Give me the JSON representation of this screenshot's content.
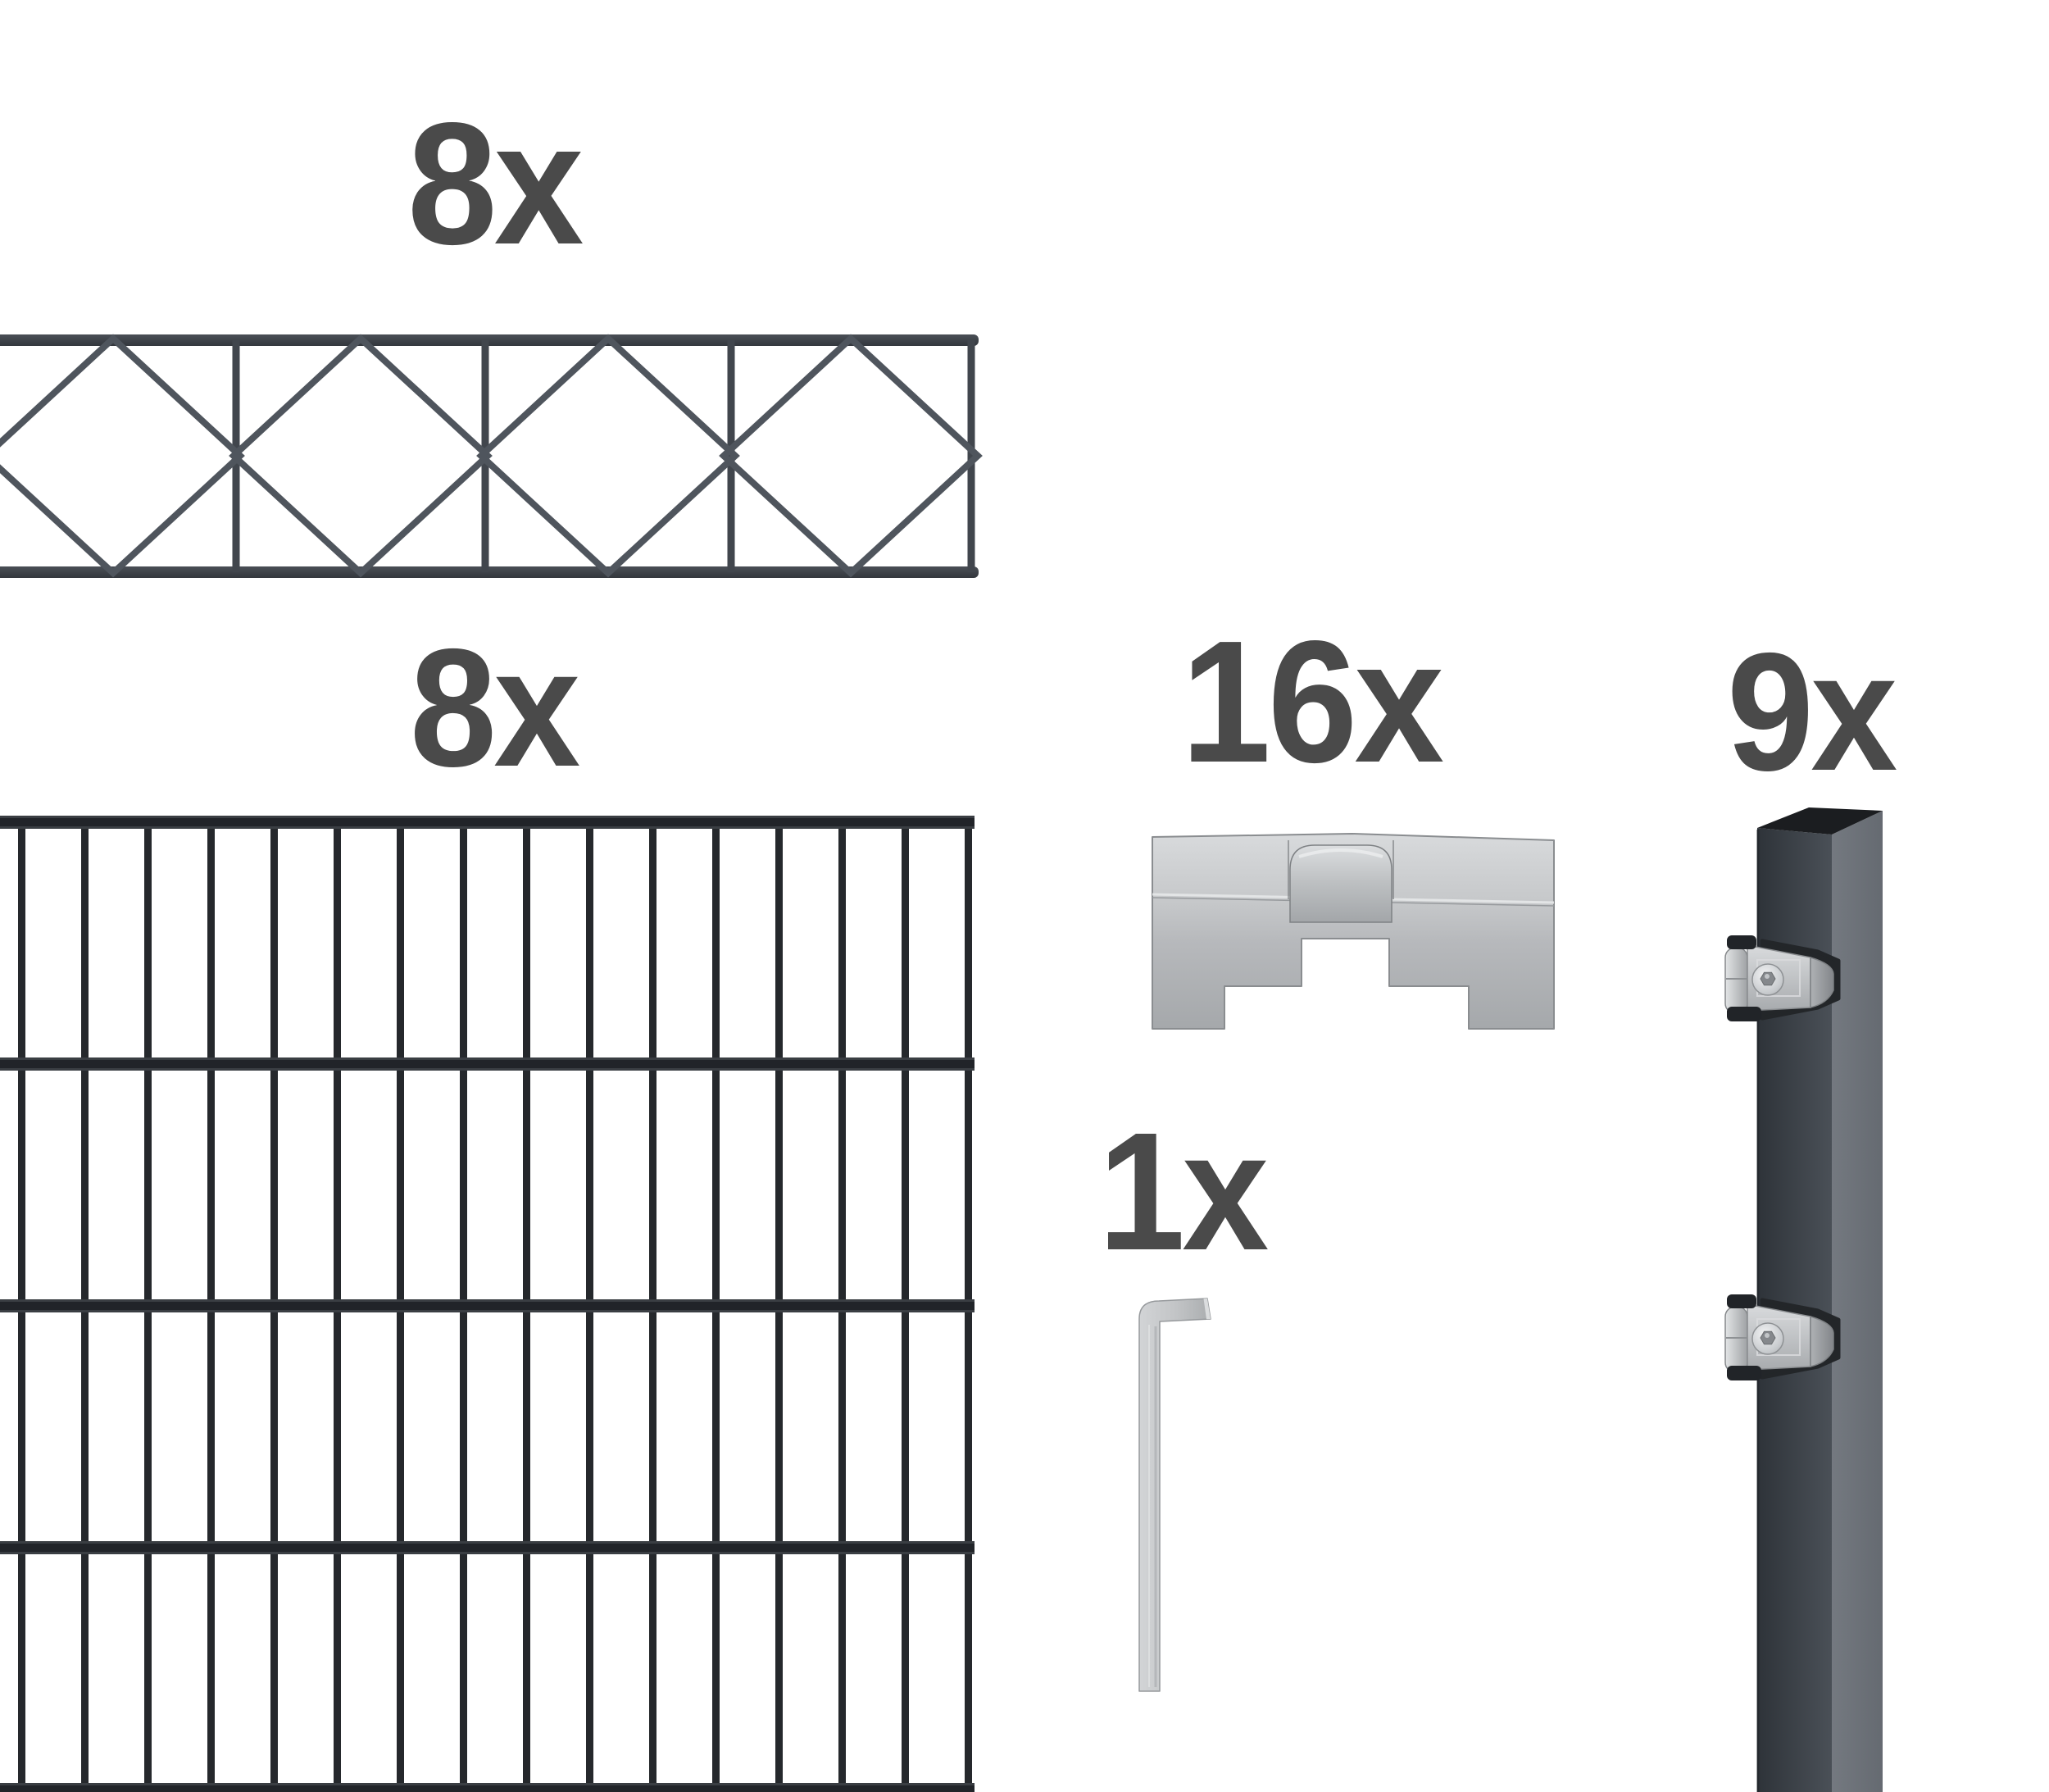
{
  "kit_items": {
    "decor_panel": {
      "qty": "8x",
      "name": "ornamental-topper-panel-diamond-pattern"
    },
    "mesh_panel": {
      "qty": "8x",
      "name": "double-rod-mesh-fence-panel"
    },
    "cover_clamp": {
      "qty": "16x",
      "name": "galvanized-cover-clamp-plate"
    },
    "hex_key": {
      "qty": "1x",
      "name": "allen-key"
    },
    "post": {
      "qty": "9x",
      "name": "anthracite-fence-post-with-clamps"
    }
  },
  "colors": {
    "label-ink": "#4a4a4a",
    "mesh-wire": "#25282c",
    "mesh-band": "#212429",
    "mesh-band-hi": "#3a3e43",
    "decor-wire": "#4f555d",
    "decor-frame": "#41464d",
    "post-side": "#6e737a",
    "post-cap": "#1b1d20",
    "plastic-black": "#212428",
    "bg": "#ffffff"
  }
}
